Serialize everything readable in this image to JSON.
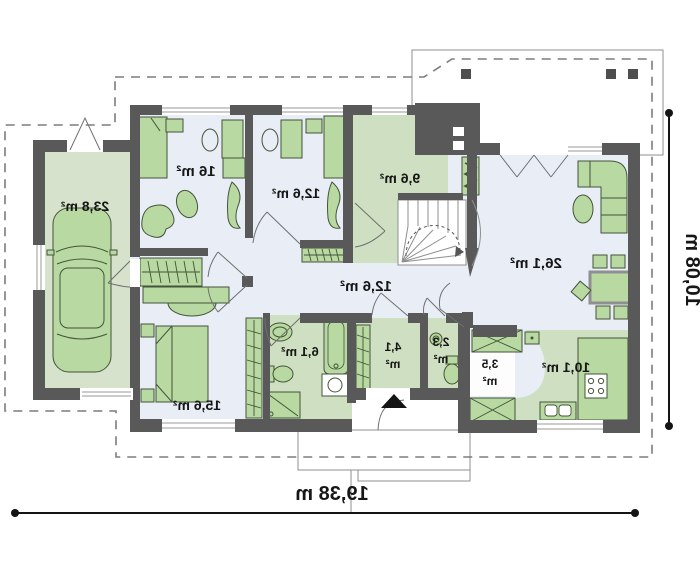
{
  "plan": {
    "rooms": {
      "garage": {
        "area": "23,8 m²"
      },
      "room1": {
        "area": "16 m²"
      },
      "room2": {
        "area": "12,6 m²"
      },
      "utility": {
        "area": "9,6 m²"
      },
      "living_room": {
        "area": "26,1 m²"
      },
      "hall": {
        "area": "12,6 m²"
      },
      "bedroom": {
        "area": "15,6 m²"
      },
      "bathroom": {
        "area": "6,1 m²"
      },
      "wardrobe": {
        "area_value": "4,1",
        "area_unit": "m²"
      },
      "wc": {
        "area_value": "2,3",
        "area_unit": "m²"
      },
      "pantry": {
        "area_value": "3,5",
        "area_unit": "m²"
      },
      "kitchen": {
        "area": "10,1 m²"
      }
    },
    "dimensions": {
      "total_width": "19,38 m",
      "total_height": "10,08 m"
    },
    "colors": {
      "wall": "#595959",
      "floor_light": "#e8edf6",
      "floor_green": "#cfdfc2",
      "furniture": "#b8d9a1",
      "furniture_outline": "#44543a",
      "dimension": "#141414"
    }
  }
}
